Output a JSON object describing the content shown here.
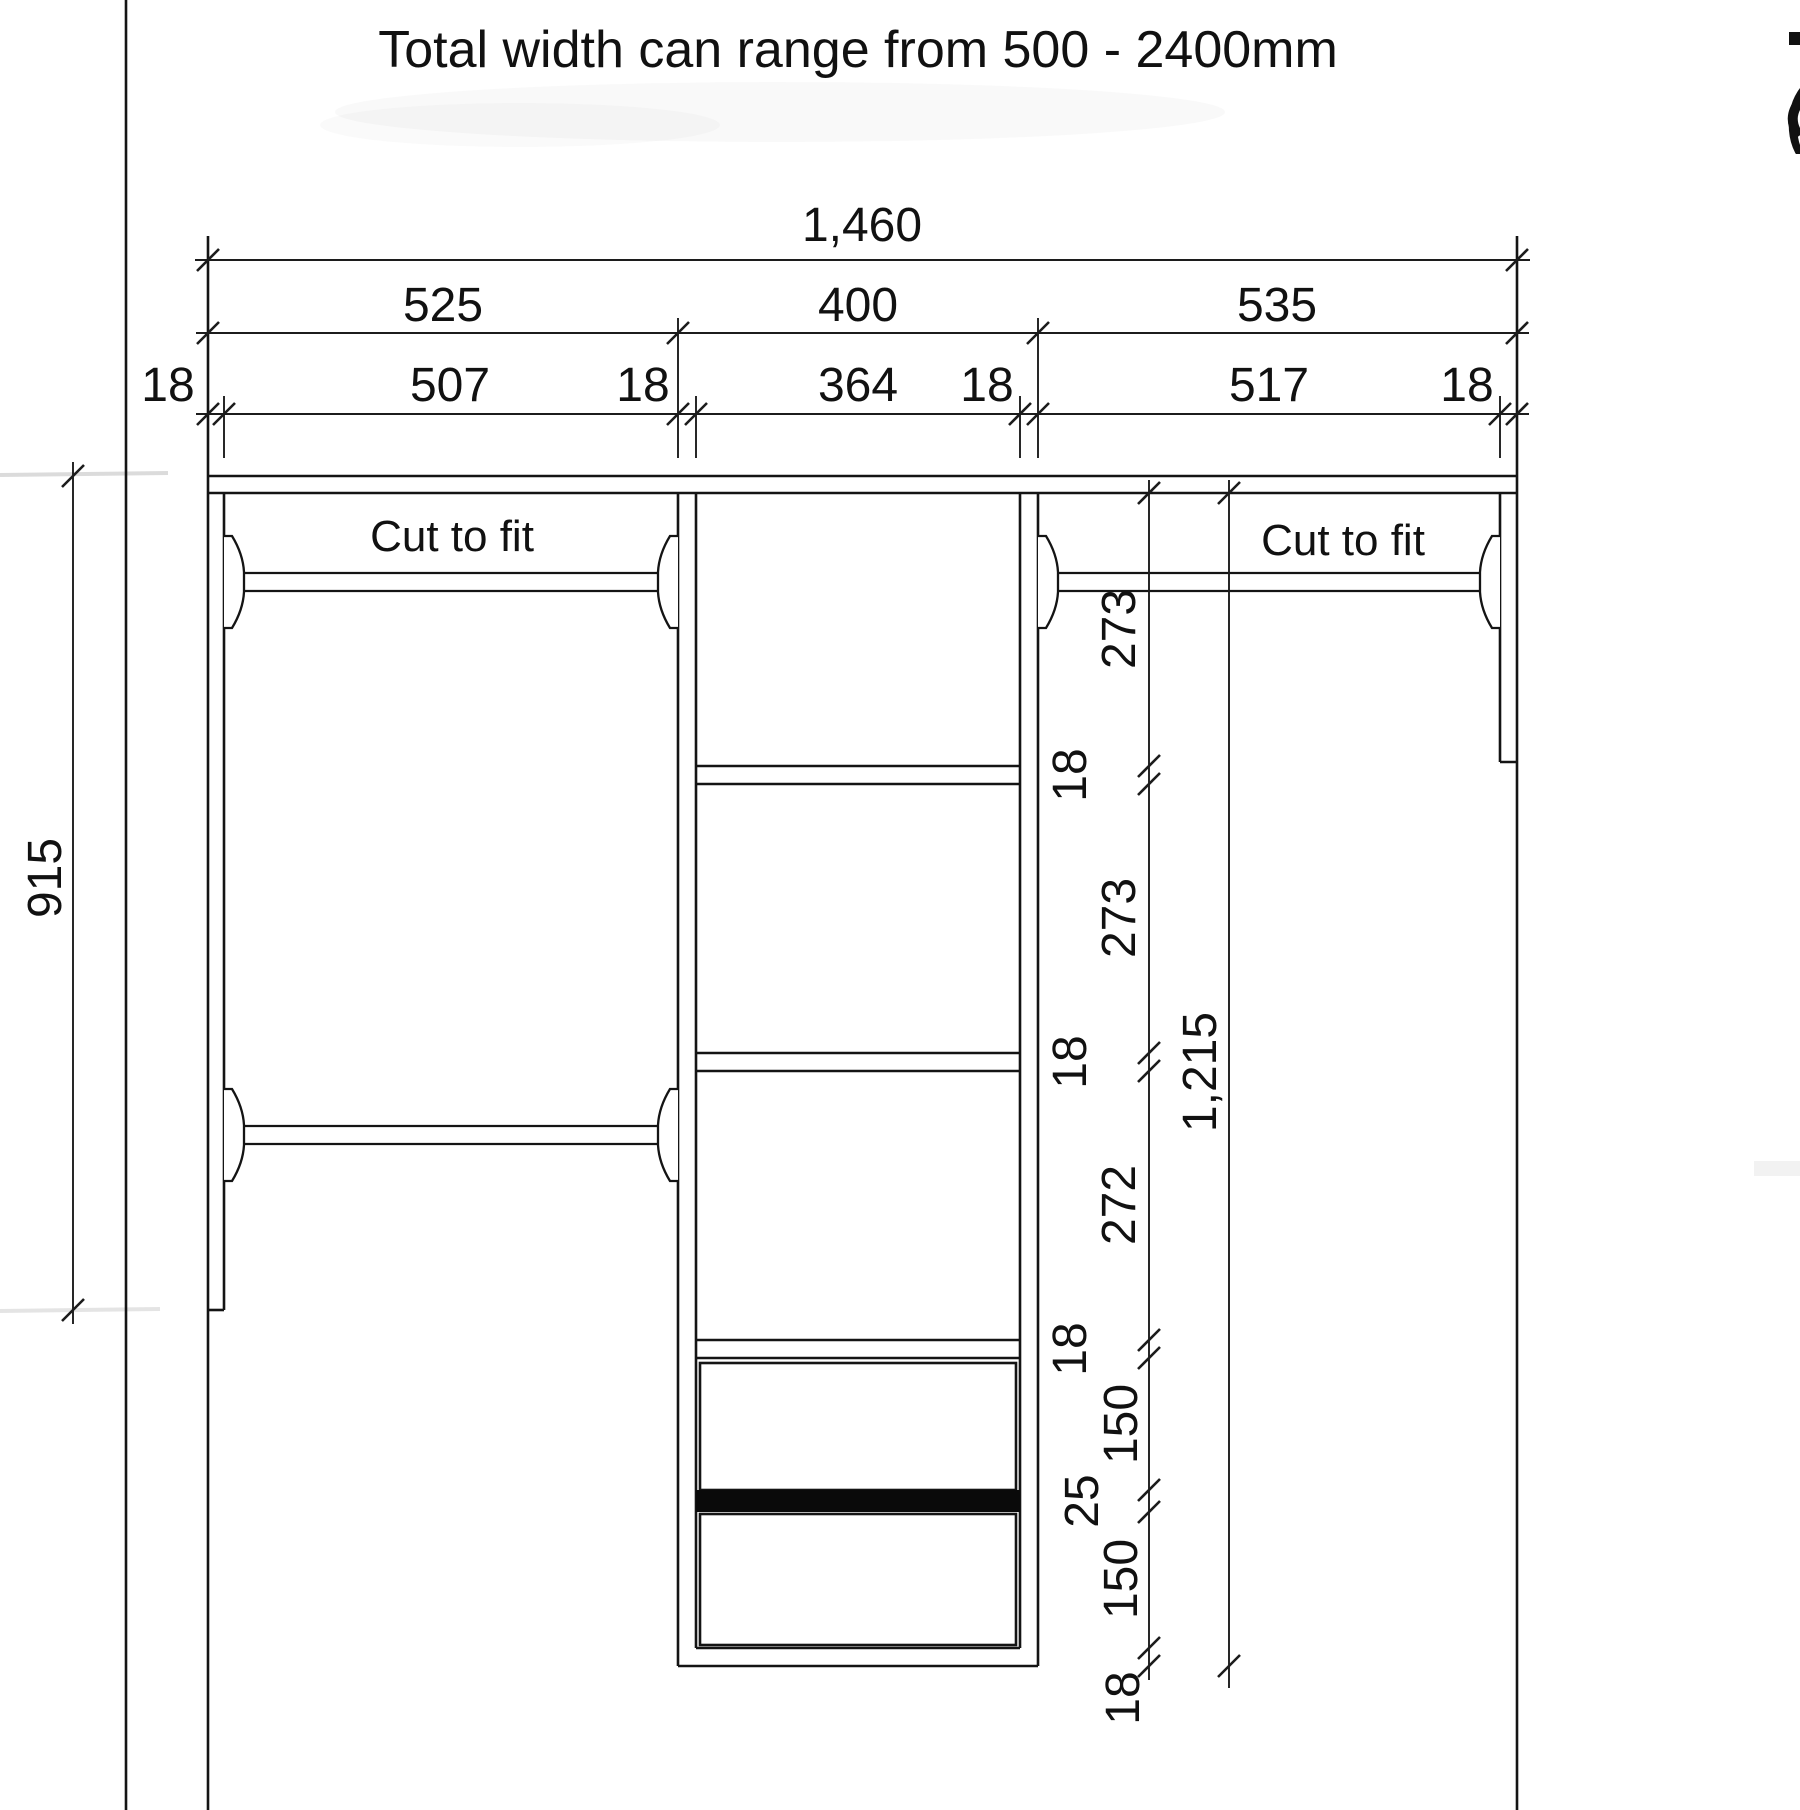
{
  "title": "Total width can range from 500 - 2400mm",
  "sections": {
    "left_label": "Cut to fit",
    "right_label": "Cut to fit"
  },
  "dimensions": {
    "total_width": "1,460",
    "row_sections": [
      "525",
      "400",
      "535"
    ],
    "row_detail": [
      "18",
      "507",
      "18",
      "364",
      "18",
      "517",
      "18"
    ],
    "left_height": "915",
    "vertical_chain": [
      "273",
      "18",
      "273",
      "18",
      "272",
      "18",
      "150",
      "25",
      "150",
      "18"
    ],
    "vertical_total": "1,215"
  },
  "edge_fragment": "("
}
